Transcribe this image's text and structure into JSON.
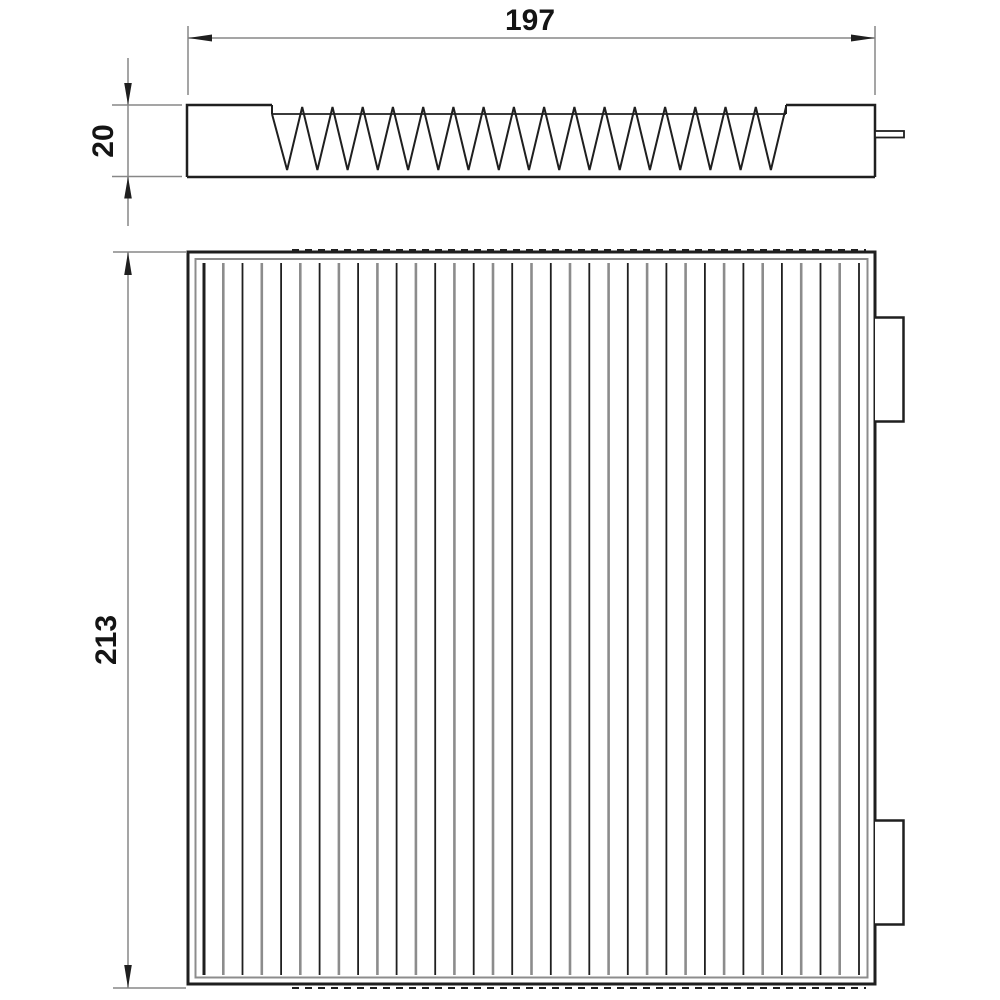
{
  "drawing": {
    "title": "pleated-filter-technical-drawing",
    "background": "#ffffff",
    "object_line_color": "#1f1f1f",
    "secondary_line_color": "#8c8c8c",
    "dimension_line_color": "#878787",
    "text_color": "#141414",
    "labels": {
      "width": "197",
      "thickness": "20",
      "height": "213"
    },
    "side_view": {
      "pleat_count": 17
    },
    "front_view": {
      "pleat_line_count": 35,
      "tab_count": 2
    }
  }
}
